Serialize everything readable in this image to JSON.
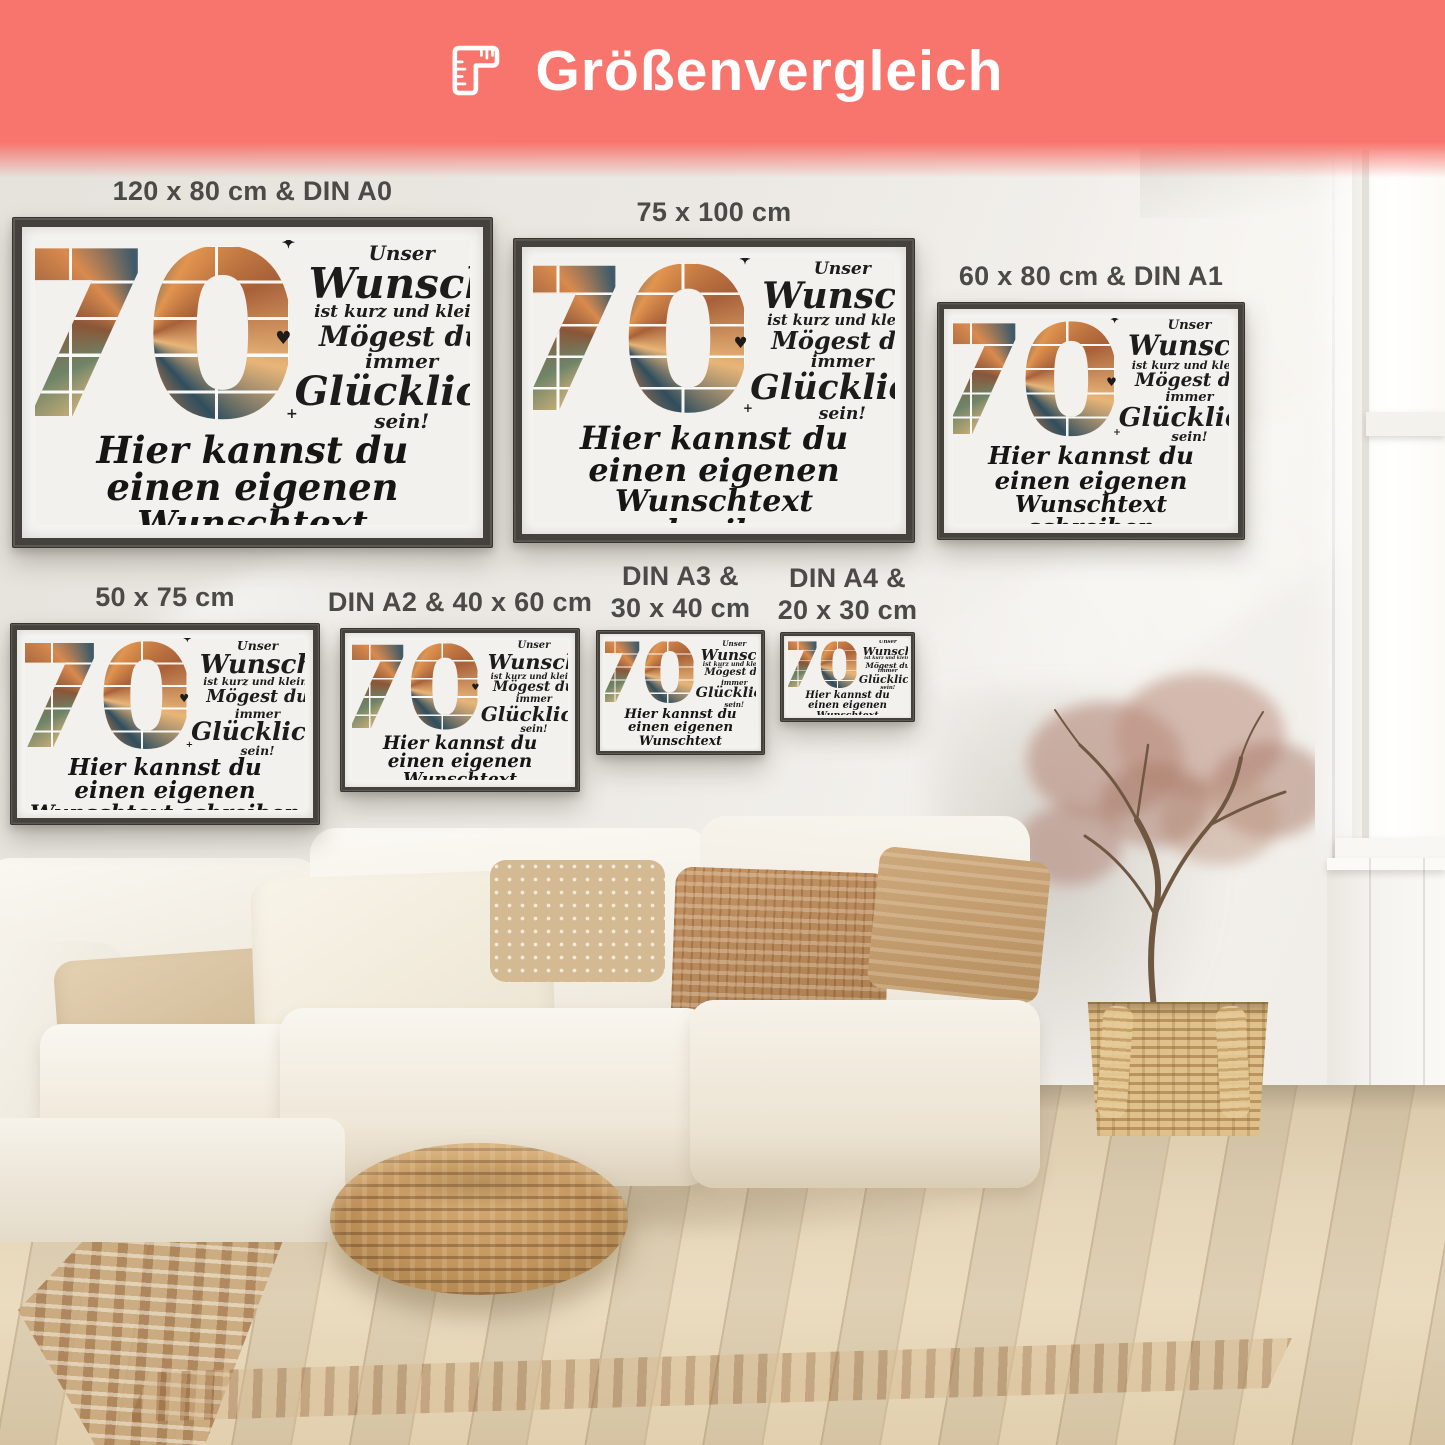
{
  "header": {
    "title": "Größenvergleich",
    "icon": "corner-ruler",
    "bg_color": "#f8756d",
    "text_color": "#ffffff"
  },
  "posters": [
    {
      "label": "120 x 80 cm & DIN A0"
    },
    {
      "label": "75 x 100 cm"
    },
    {
      "label": "60 x 80 cm & DIN A1"
    },
    {
      "label": "50 x 75 cm"
    },
    {
      "label": "DIN A2 & 40 x 60 cm"
    },
    {
      "label": "DIN A3 &",
      "label2": "30 x 40 cm"
    },
    {
      "label": "DIN A4 &",
      "label2": "20 x 30 cm"
    }
  ],
  "poster_content": {
    "number": "70",
    "wish_line1": "Unser",
    "wish_line2": "Wunsch",
    "wish_line3": "ist kurz und klein:",
    "wish_line4": "Mögest du",
    "wish_line5": "immer",
    "wish_line6": "Glücklich",
    "wish_line7": "sein!",
    "custom_line1": "Hier kannst du einen eigenen",
    "custom_line2": "Wunschtext schreiben"
  },
  "icons": {
    "heart": "♥",
    "sparkle": "✦",
    "plus": "+"
  },
  "colors": {
    "header_bg": "#f8756d",
    "label_text": "#4b4a47",
    "poster_text": "#1c1b19",
    "frame": "#45423e"
  }
}
